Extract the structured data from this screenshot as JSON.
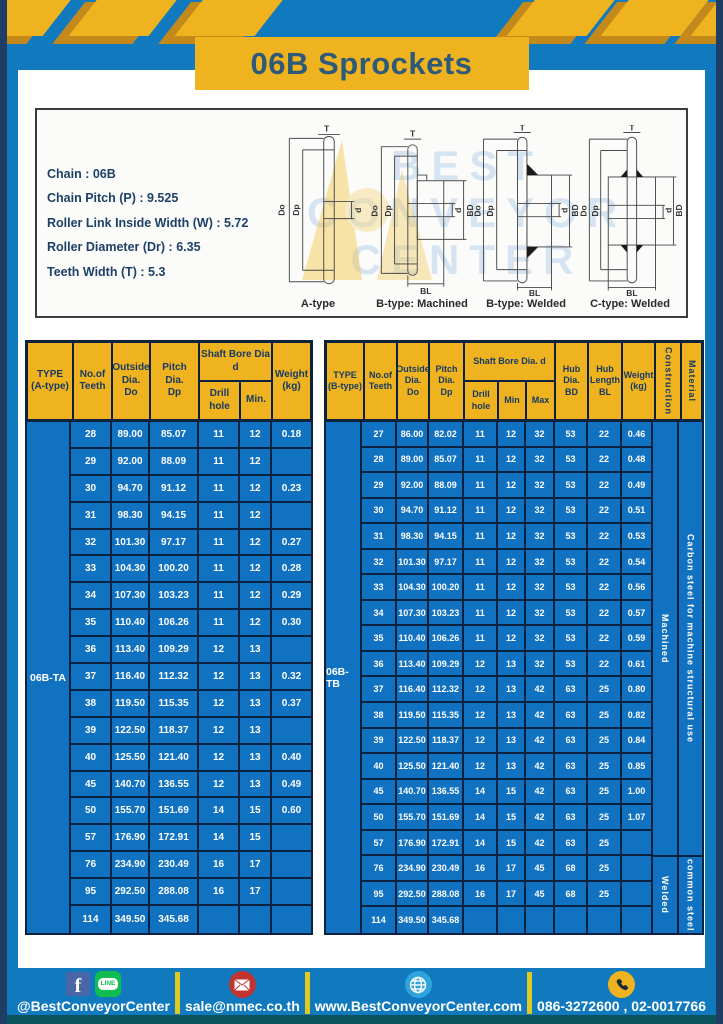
{
  "page": {
    "title": "06B Sprockets"
  },
  "colors": {
    "accent_yellow": "#efb320",
    "frame_blue": "#117abf",
    "table_blue": "#1172c2",
    "border_navy": "#0a2240",
    "footer_strip_teal": "#0b545d"
  },
  "specs": {
    "lines": [
      "Chain : 06B",
      "Chain Pitch (P) : 9.525",
      "Roller Link Inside Width (W) : 5.72",
      "Roller Diameter (Dr) : 6.35",
      "Teeth Width (T) : 5.3"
    ]
  },
  "diagrams": {
    "captions": [
      "A-type",
      "B-type: Machined",
      "B-type: Welded",
      "C-type: Welded"
    ],
    "labels": {
      "t": "T",
      "outside": "Do",
      "pitch": "Dp",
      "bore": "d",
      "hub_dia": "BD",
      "hub_len": "BL"
    },
    "watermark": [
      "BEST",
      "CONVEYOR",
      "CENTER"
    ]
  },
  "table_a": {
    "type_label": "06B-TA",
    "col_type": "TYPE\n(A-type)",
    "col_teeth": "No.of\nTeeth",
    "col_outside": "Outside\nDia.\nDo",
    "col_pitch": "Pitch Dia.\nDp",
    "col_shaft_group": "Shaft Bore Dia d",
    "col_drill": "Drill hole",
    "col_min": "Min.",
    "col_weight": "Weight\n(kg)",
    "rows": [
      [
        "28",
        "89.00",
        "85.07",
        "11",
        "12",
        "0.18"
      ],
      [
        "29",
        "92.00",
        "88.09",
        "11",
        "12",
        ""
      ],
      [
        "30",
        "94.70",
        "91.12",
        "11",
        "12",
        "0.23"
      ],
      [
        "31",
        "98.30",
        "94.15",
        "11",
        "12",
        ""
      ],
      [
        "32",
        "101.30",
        "97.17",
        "11",
        "12",
        "0.27"
      ],
      [
        "33",
        "104.30",
        "100.20",
        "11",
        "12",
        "0.28"
      ],
      [
        "34",
        "107.30",
        "103.23",
        "11",
        "12",
        "0.29"
      ],
      [
        "35",
        "110.40",
        "106.26",
        "11",
        "12",
        "0.30"
      ],
      [
        "36",
        "113.40",
        "109.29",
        "12",
        "13",
        ""
      ],
      [
        "37",
        "116.40",
        "112.32",
        "12",
        "13",
        "0.32"
      ],
      [
        "38",
        "119.50",
        "115.35",
        "12",
        "13",
        "0.37"
      ],
      [
        "39",
        "122.50",
        "118.37",
        "12",
        "13",
        ""
      ],
      [
        "40",
        "125.50",
        "121.40",
        "12",
        "13",
        "0.40"
      ],
      [
        "45",
        "140.70",
        "136.55",
        "12",
        "13",
        "0.49"
      ],
      [
        "50",
        "155.70",
        "151.69",
        "14",
        "15",
        "0.60"
      ],
      [
        "57",
        "176.90",
        "172.91",
        "14",
        "15",
        ""
      ],
      [
        "76",
        "234.90",
        "230.49",
        "16",
        "17",
        ""
      ],
      [
        "95",
        "292.50",
        "288.08",
        "16",
        "17",
        ""
      ],
      [
        "114",
        "349.50",
        "345.68",
        "",
        "",
        ""
      ]
    ]
  },
  "table_b": {
    "type_label": "06B-TB",
    "col_type": "TYPE\n(B-type)",
    "col_teeth": "No.of\nTeeth",
    "col_outside": "Outside\nDia.\nDo",
    "col_pitch": "Pitch\nDia.\nDp",
    "col_shaft_group": "Shaft Bore Dia. d",
    "col_drill": "Drill hole",
    "col_min": "Min",
    "col_max": "Max",
    "col_hub_dia": "Hub\nDia.\nBD",
    "col_hub_len": "Hub\nLength\nBL",
    "col_weight": "Weight\n(kg)",
    "col_construction": "Construction",
    "col_material": "Material",
    "construction_spans": [
      {
        "label": "Machined"
      },
      {
        "label": "Welded"
      }
    ],
    "material_spans": [
      {
        "label": "Carbon steel for machine structural use"
      },
      {
        "label": "common steel"
      }
    ],
    "rows": [
      [
        "27",
        "86.00",
        "82.02",
        "11",
        "12",
        "32",
        "53",
        "22",
        "0.46"
      ],
      [
        "28",
        "89.00",
        "85.07",
        "11",
        "12",
        "32",
        "53",
        "22",
        "0.48"
      ],
      [
        "29",
        "92.00",
        "88.09",
        "11",
        "12",
        "32",
        "53",
        "22",
        "0.49"
      ],
      [
        "30",
        "94.70",
        "91.12",
        "11",
        "12",
        "32",
        "53",
        "22",
        "0.51"
      ],
      [
        "31",
        "98.30",
        "94.15",
        "11",
        "12",
        "32",
        "53",
        "22",
        "0.53"
      ],
      [
        "32",
        "101.30",
        "97.17",
        "11",
        "12",
        "32",
        "53",
        "22",
        "0.54"
      ],
      [
        "33",
        "104.30",
        "100.20",
        "11",
        "12",
        "32",
        "53",
        "22",
        "0.56"
      ],
      [
        "34",
        "107.30",
        "103.23",
        "11",
        "12",
        "32",
        "53",
        "22",
        "0.57"
      ],
      [
        "35",
        "110.40",
        "106.26",
        "11",
        "12",
        "32",
        "53",
        "22",
        "0.59"
      ],
      [
        "36",
        "113.40",
        "109.29",
        "12",
        "13",
        "32",
        "53",
        "22",
        "0.61"
      ],
      [
        "37",
        "116.40",
        "112.32",
        "12",
        "13",
        "42",
        "63",
        "25",
        "0.80"
      ],
      [
        "38",
        "119.50",
        "115.35",
        "12",
        "13",
        "42",
        "63",
        "25",
        "0.82"
      ],
      [
        "39",
        "122.50",
        "118.37",
        "12",
        "13",
        "42",
        "63",
        "25",
        "0.84"
      ],
      [
        "40",
        "125.50",
        "121.40",
        "12",
        "13",
        "42",
        "63",
        "25",
        "0.85"
      ],
      [
        "45",
        "140.70",
        "136.55",
        "14",
        "15",
        "42",
        "63",
        "25",
        "1.00"
      ],
      [
        "50",
        "155.70",
        "151.69",
        "14",
        "15",
        "42",
        "63",
        "25",
        "1.07"
      ],
      [
        "57",
        "176.90",
        "172.91",
        "14",
        "15",
        "42",
        "63",
        "25",
        ""
      ],
      [
        "76",
        "234.90",
        "230.49",
        "16",
        "17",
        "45",
        "68",
        "25",
        ""
      ],
      [
        "95",
        "292.50",
        "288.08",
        "16",
        "17",
        "45",
        "68",
        "25",
        ""
      ],
      [
        "114",
        "349.50",
        "345.68",
        "",
        "",
        "",
        "",
        "",
        ""
      ]
    ]
  },
  "footer": {
    "facebook_glyph": "f",
    "line_text": "LINE",
    "social_label": "@BestConveyorCenter",
    "email": "sale@nmec.co.th",
    "website": "www.BestConveyorCenter.com",
    "phones": "086-3272600 , 02-0017766"
  }
}
